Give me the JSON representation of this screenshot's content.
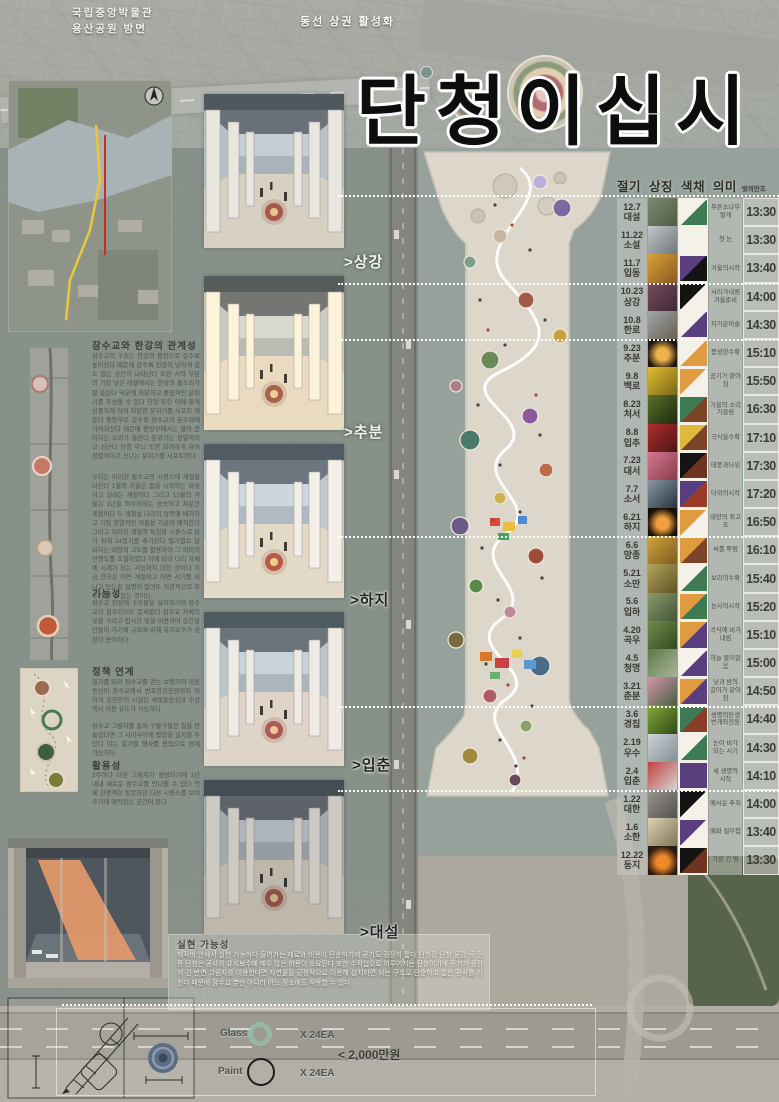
{
  "poster": {
    "title": "단청이십시",
    "top_left_caption_line1": "국립중앙박물관",
    "top_left_caption_line2": "용산공원 방면",
    "top_right_caption": "동선 상권 활성화"
  },
  "left": {
    "section1": {
      "heading": "잠수교와 한강의 관계성",
      "para1": "잠수교의 구조는 한강의 중앙으로 갈수록 높아진다 때문에 갈수록 천장이 낮아져 힘도 없는 공간이 나타난다 또한 시작 부분의 가장 낮은 레벨에서는 한강의 물소리가 잘 들린다 덕분에 차분하고 중립적인 분위기를 조성할 수 있다 단청 또한 이에 맞게 심플하게 하여 차분한 분위기를 서포트 해준다 중앙부로 갈수록 잠수교의 분수대에 가까워진다 때문에 중앙부에서는 물이 쏟아지는 소리가 들린다 분위기는 정열적이고 신난다 단청 무늬 또한 화려하게 하여 정열적이고 신나는 분위기를 서포트한다",
      "para2": "우리는 이러한 잠수교의 시퀀스에 계절을 더한다 1월의 겨울은 봄을 시작하는 파릇하고 설레는 계절이다 그리고 12월의 겨울은 1년을 마무리하는 성숙하고 차분한 계절이다 두 계절을 다리의 양쪽에 배치하고 가장 정열적인 여름을 가운데 배치한다 그리고 이러한 계절적 특징을 시퀀스로 담기 위해 24절기를 추가한다 절기별로 달라지는 태양의 고도를 활용하여 그 의미의 선명도를 조절하였다 이에 따라 다리 자체에 시계가 되는 기능까지 더한 것이다 지금 한국은 어떤 계절이고 어떤 시기를 지나고 있는지 설명이 없어도 직관적으로 모두가 알 수 있는 것이다"
    },
    "function": {
      "heading": "기능성",
      "para": "잠수교 천장에 구조물을 설치하기에 잠수교가 침수되어도 문제없다 잠수교 자체의 빛을 가리고 입사한 빛을 이용하여 공간을 만들어 가기에 규모에 비해 유지보수가 굉장히 용이하다"
    },
    "policy": {
      "heading": "정책 연계",
      "para1": "절기를 따라 잠수교를 걷는 보행자의 이동 동선이 잠수교에서 반포한강공원까지 이어져 공원안의 시설인 새빛둥둥섬과 수상택시 이용 유도가 가능하다",
      "para2": "잠수교 그림자를 통해 구불구불한 길을 만들었다면 그 사이사이에 팝업을 설치할 수 있다 이는 절기별 행사를 팝업으로 연계 가능하다"
    },
    "usage": {
      "heading": "활용성",
      "para": "2주마다 다른 그림자가 생성되기에 1년 내내 새로운 잠수교를 만나볼 수 있다 언제 관광객이 방문하던 다른 시퀀스를 보여주기에 매력있는 공간이 된다"
    }
  },
  "middle": {
    "labels": [
      ">상강",
      ">추분",
      ">하지",
      ">입춘",
      ">대설"
    ]
  },
  "bottom": {
    "feasibility_heading": "실현 가능성",
    "feasibility_para": "제작비 안에서 실현 가능하다 들어가는 재료와 비용이 단순하기에 공기도 굉장히 짧다 단청장 단청 물감 등 전통 단청은 공사와 유지보수에 매우 많은 비용이 소요된다 또한 수작업으로 이루어지는 단청이기에 공기가 굉장히 긴 반면 그림자를 이용한다면 자연물을 긍정적으로 이용해 설치하면 되는 구조로 단순하고 짧은 공사를 거친다 때문에 잠수교 뿐만 아니라 어느 장소에도 적용할 수 있다",
    "legend": {
      "glass_label": "Glass",
      "glass_qty": "X 24EA",
      "paint_label": "Paint",
      "paint_qty": "X 24EA",
      "cost": "< 2,000만원"
    }
  },
  "table": {
    "header": {
      "title": "절기 상징 색채 의미",
      "sub": "빛의만조"
    },
    "rows": [
      {
        "date": "12.7",
        "term": "대설",
        "meaning": "푸른소나무 절개",
        "time": "13:30",
        "swatch": [
          "#f4f1e8",
          "#3e7a54"
        ],
        "photo": [
          "#7d8a70",
          "#4e5c46"
        ],
        "photo_style": "diag",
        "photo_name": "pine-tree-photo"
      },
      {
        "date": "11.22",
        "term": "소설",
        "meaning": "첫 눈",
        "time": "13:30",
        "swatch": [
          "#f4f1e8",
          "#f4f1e8"
        ],
        "photo": [
          "#c2c6c8",
          "#6f767c"
        ],
        "photo_style": "diag",
        "photo_name": "first-snow-photo"
      },
      {
        "date": "11.7",
        "term": "입동",
        "meaning": "겨울의시작",
        "time": "13:40",
        "swatch": [
          "#5a3e7e",
          "#141414"
        ],
        "photo": [
          "#d9a23a",
          "#8a5a20"
        ],
        "photo_style": "diag",
        "photo_name": "fallen-leaves-photo"
      },
      {
        "date": "10.23",
        "term": "상강",
        "meaning": "서리가내림 겨울준비",
        "time": "14:00",
        "swatch": [
          "#141414",
          "#f4f1e8"
        ],
        "photo": [
          "#7c4a5c",
          "#3c2a38"
        ],
        "photo_style": "diag",
        "photo_name": "frost-leaves-photo"
      },
      {
        "date": "10.8",
        "term": "한로",
        "meaning": "차가운이슬",
        "time": "14:30",
        "swatch": [
          "#f4f1e8",
          "#5a3e7e"
        ],
        "photo": [
          "#a0a6a8",
          "#6b6054"
        ],
        "photo_style": "diag",
        "photo_name": "duck-water-photo"
      },
      {
        "date": "9.23",
        "term": "추분",
        "meaning": "풍성한수확",
        "time": "15:10",
        "swatch": [
          "#f4f1e8",
          "#e09a40"
        ],
        "photo": [
          "#efb24a",
          "#201610"
        ],
        "photo_style": "radial",
        "photo_name": "full-moon-photo"
      },
      {
        "date": "9.8",
        "term": "백로",
        "meaning": "공기가 맑아짐",
        "time": "15:50",
        "swatch": [
          "#e09a40",
          "#f4f1e8"
        ],
        "photo": [
          "#e5be2e",
          "#76671a"
        ],
        "photo_style": "diag",
        "photo_name": "yellow-flowers-photo"
      },
      {
        "date": "8.23",
        "term": "처서",
        "meaning": "가을의 소리가들림",
        "time": "16:30",
        "swatch": [
          "#3e7a54",
          "#7c4426"
        ],
        "photo": [
          "#5a7028",
          "#1e2a12"
        ],
        "photo_style": "diag",
        "photo_name": "insect-photo"
      },
      {
        "date": "8.8",
        "term": "입추",
        "meaning": "곡식을수확",
        "time": "17:10",
        "swatch": [
          "#e0b93a",
          "#7c4426"
        ],
        "photo": [
          "#b02e2e",
          "#4e1414"
        ],
        "photo_style": "diag",
        "photo_name": "red-berries-photo"
      },
      {
        "date": "7.23",
        "term": "대서",
        "meaning": "태풍과더위",
        "time": "17:30",
        "swatch": [
          "#141414",
          "#6e3420"
        ],
        "photo": [
          "#d27890",
          "#8a3a4a"
        ],
        "photo_style": "diag",
        "photo_name": "dragon-painting-photo"
      },
      {
        "date": "7.7",
        "term": "소서",
        "meaning": "더위의시작",
        "time": "17:20",
        "swatch": [
          "#5a3e7e",
          "#9c3a28"
        ],
        "photo": [
          "#8a98a4",
          "#27343f"
        ],
        "photo_style": "diag",
        "photo_name": "waves-photo"
      },
      {
        "date": "6.21",
        "term": "하지",
        "meaning": "태양의 최고조",
        "time": "16:50",
        "swatch": [
          "#e09a40",
          "#f4f1e8"
        ],
        "photo": [
          "#f0a040",
          "#190f06"
        ],
        "photo_style": "radial",
        "photo_name": "fireworks-photo"
      },
      {
        "date": "6.6",
        "term": "망종",
        "meaning": "씨를 뿌림",
        "time": "16:10",
        "swatch": [
          "#e09a40",
          "#7c4426"
        ],
        "photo": [
          "#d2a440",
          "#7c5c1c"
        ],
        "photo_style": "diag",
        "photo_name": "wheat-photo"
      },
      {
        "date": "5.21",
        "term": "소만",
        "meaning": "보리의수확",
        "time": "15:40",
        "swatch": [
          "#f4f1e8",
          "#3e7a54"
        ],
        "photo": [
          "#b4a45c",
          "#5e5224"
        ],
        "photo_style": "diag",
        "photo_name": "barley-photo"
      },
      {
        "date": "5.6",
        "term": "입하",
        "meaning": "농사의시작",
        "time": "15:20",
        "swatch": [
          "#e09a40",
          "#3e7a54"
        ],
        "photo": [
          "#8a9a6a",
          "#44543a"
        ],
        "photo_style": "diag",
        "photo_name": "rice-planting-photo"
      },
      {
        "date": "4.20",
        "term": "곡우",
        "meaning": "곡식에 비가내림",
        "time": "15:10",
        "swatch": [
          "#e09a40",
          "#5a3e7e"
        ],
        "photo": [
          "#6f8c49",
          "#324a22"
        ],
        "photo_style": "diag",
        "photo_name": "green-rice-photo"
      },
      {
        "date": "4.5",
        "term": "청명",
        "meaning": "하늘 물이맑음",
        "time": "15:00",
        "swatch": [
          "#f4f1e8",
          "#5a3e7e"
        ],
        "photo": [
          "#5c7a46",
          "#a8b49a"
        ],
        "photo_style": "diag",
        "photo_name": "tree-photo"
      },
      {
        "date": "3.21",
        "term": "춘분",
        "meaning": "낮과 밤의 길이가 같아짐",
        "time": "14:50",
        "swatch": [
          "#e09a40",
          "#5a3e7e"
        ],
        "photo": [
          "#d892aa",
          "#44633f"
        ],
        "photo_style": "diag",
        "photo_name": "lotus-photo"
      },
      {
        "date": "3.6",
        "term": "경칩",
        "meaning": "생명의탄생 번개와천둥",
        "time": "14:40",
        "swatch": [
          "#3e7a54",
          "#8a3c28"
        ],
        "photo": [
          "#86a83c",
          "#2f4a16"
        ],
        "photo_style": "diag",
        "photo_name": "leaf-frog-photo"
      },
      {
        "date": "2.19",
        "term": "우수",
        "meaning": "눈이 비가 되는 시기",
        "time": "14:30",
        "swatch": [
          "#f4f1e8",
          "#3e7a54"
        ],
        "photo": [
          "#cdd2d6",
          "#848e96"
        ],
        "photo_style": "diag",
        "photo_name": "snow-mountain-photo"
      },
      {
        "date": "2.4",
        "term": "입춘",
        "meaning": "새 생명의 시작",
        "time": "14:10",
        "swatch": [
          "#5a3e7e",
          "#5a3e7e"
        ],
        "photo": [
          "#c04040",
          "#d8d4d0"
        ],
        "photo_style": "diag",
        "photo_name": "red-flower-photo"
      },
      {
        "date": "1.22",
        "term": "대한",
        "meaning": "매서운 추위",
        "time": "14:00",
        "swatch": [
          "#141414",
          "#f4f1e8"
        ],
        "photo": [
          "#98948e",
          "#55524e"
        ],
        "photo_style": "diag",
        "photo_name": "winter-city-photo"
      },
      {
        "date": "1.6",
        "term": "소한",
        "meaning": "매화 필무렵",
        "time": "13:40",
        "swatch": [
          "#5a3e7e",
          "#f4f1e8"
        ],
        "photo": [
          "#ddd2b4",
          "#7e7656"
        ],
        "photo_style": "diag",
        "photo_name": "plum-blossom-photo"
      },
      {
        "date": "12.22",
        "term": "동지",
        "meaning": "가장 긴 밤",
        "time": "13:30",
        "swatch": [
          "#141414",
          "#6e3420"
        ],
        "photo": [
          "#ef8a2a",
          "#2d1a10"
        ],
        "photo_style": "radial",
        "photo_name": "sunset-photo"
      }
    ]
  },
  "colors": {
    "dancheong_green": "#3e7a54",
    "dancheong_orange": "#e09a40",
    "dancheong_purple": "#5a3e7e",
    "dancheong_black": "#141414",
    "dancheong_white": "#f4f1e8",
    "dancheong_brown": "#7c4426"
  }
}
